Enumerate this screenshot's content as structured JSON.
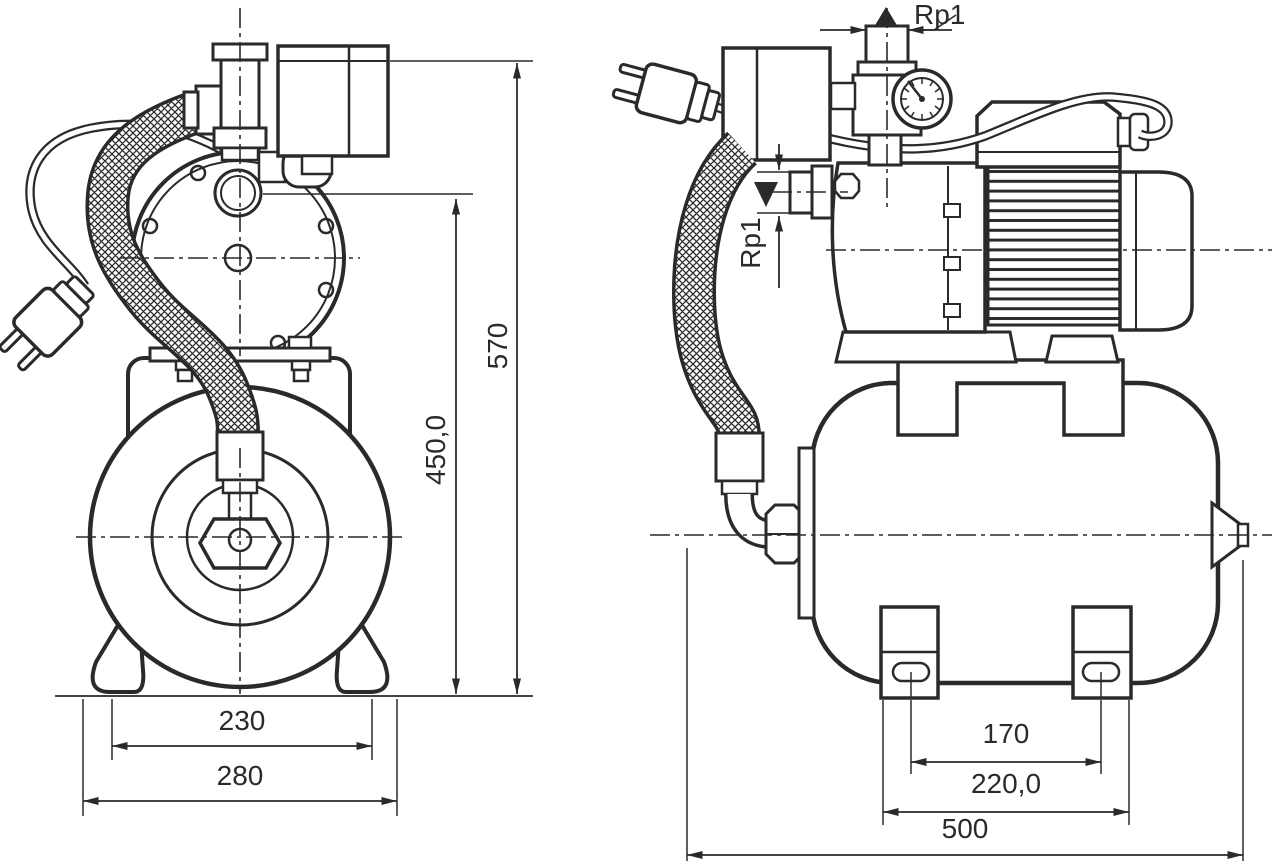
{
  "drawing": {
    "type": "technical dimensional drawing, pump with pressure tank, two orthographic views",
    "background": "#ffffff",
    "line_color": "#2b2a28",
    "front": {
      "dims": {
        "feet_spacing": "230",
        "base_width": "280",
        "port_center_height": "450,0",
        "overall_height": "570"
      }
    },
    "side": {
      "dims": {
        "foot_slot_spacing": "170",
        "feet_outer_width": "220,0",
        "overall_length": "500"
      },
      "ports": {
        "discharge": "Rp1",
        "suction": "Rp1"
      }
    }
  }
}
